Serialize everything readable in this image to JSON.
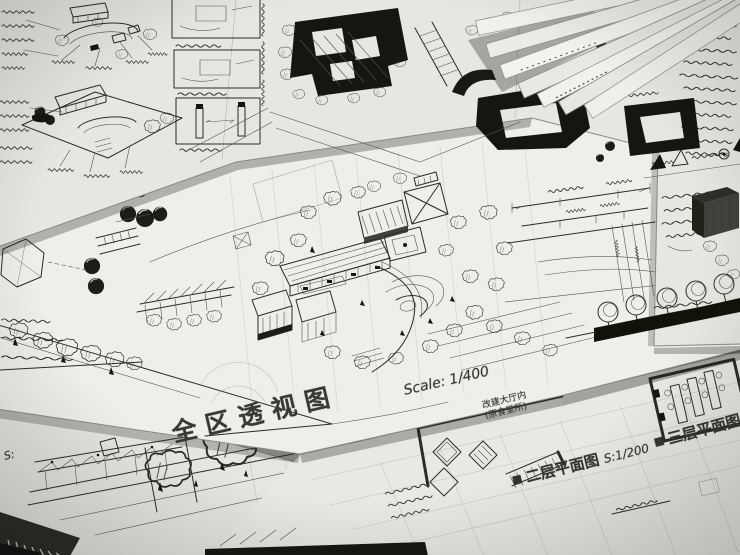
{
  "meta": {
    "description": "Photograph of overlapping hand-drawn architectural design sketch sheets (site plans, axonometric perspective, floor plans, sections) with handwritten Chinese annotations",
    "type": "photograph"
  },
  "palette": {
    "paper": "#efeeea",
    "paper_dim": "#e4e3de",
    "ink": "#2c2b28",
    "ink_dark_fill": "#161511",
    "background": "#9b9a93",
    "shadow": "#3a3934"
  },
  "labels": {
    "perspective": {
      "title": "全区透视图",
      "scale": "Scale: 1/400"
    },
    "floor_plan_2": {
      "title": "二层平面图",
      "scale": "S:1/200"
    },
    "floor_plan_3": {
      "title": "三层平面图"
    },
    "hall_note": {
      "line1": "改建大厅内",
      "line2": "(原食堂所)"
    },
    "section": {
      "scale_prefix": "S:"
    },
    "icons": {
      "filled_square": "■"
    }
  }
}
